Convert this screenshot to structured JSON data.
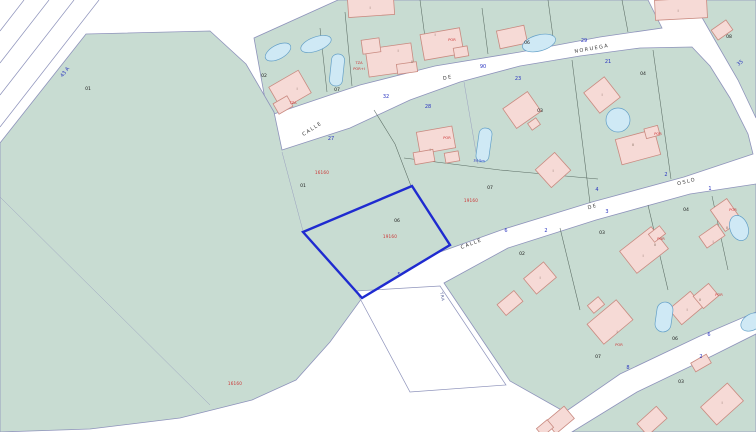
{
  "map": {
    "type": "cadastral-parcel-map",
    "colors": {
      "green": "#c8dcd2",
      "edge": "#8e93bb",
      "bld": "#f6dad6",
      "bldStroke": "#c98a80",
      "pool": "#cfe9f5",
      "poolStroke": "#64a0c8",
      "sel": "#1f2bd0",
      "blue": "#2a35c0",
      "red": "#cc3333",
      "ptext": "#222222",
      "bnd": "#5a6b63",
      "faint": "#9aa0bf"
    },
    "selected_parcel": {
      "id": "06",
      "code": "19160"
    },
    "street_names": [
      {
        "t": "CALLE",
        "x": 313,
        "y": 130,
        "r": -33
      },
      {
        "t": "DE",
        "x": 448,
        "y": 79,
        "r": -12
      },
      {
        "t": "NORUEGA",
        "x": 592,
        "y": 50,
        "r": -10
      },
      {
        "t": "CALLE",
        "x": 472,
        "y": 245,
        "r": -21
      },
      {
        "t": "DE",
        "x": 593,
        "y": 208,
        "r": -17
      },
      {
        "t": "OSLO",
        "x": 687,
        "y": 183,
        "r": -14
      },
      {
        "t": "TRA",
        "x": 441,
        "y": 297,
        "r": 78,
        "s": "tiny"
      }
    ],
    "portal_numbers": [
      {
        "t": "27",
        "x": 331,
        "y": 140
      },
      {
        "t": "32",
        "x": 386,
        "y": 98
      },
      {
        "t": "90",
        "x": 483,
        "y": 68
      },
      {
        "t": "28",
        "x": 428,
        "y": 108
      },
      {
        "t": "23",
        "x": 518,
        "y": 80
      },
      {
        "t": "29",
        "x": 584,
        "y": 42
      },
      {
        "t": "21",
        "x": 608,
        "y": 63
      },
      {
        "t": "43 A",
        "x": 66,
        "y": 73,
        "r": -52
      },
      {
        "t": "35",
        "x": 741,
        "y": 64,
        "r": -40
      },
      {
        "t": "5",
        "x": 399,
        "y": 276
      },
      {
        "t": "6",
        "x": 506,
        "y": 232
      },
      {
        "t": "2",
        "x": 546,
        "y": 232
      },
      {
        "t": "3",
        "x": 607,
        "y": 213
      },
      {
        "t": "4",
        "x": 597,
        "y": 191
      },
      {
        "t": "2",
        "x": 666,
        "y": 176
      },
      {
        "t": "1",
        "x": 710,
        "y": 190
      },
      {
        "t": "8",
        "x": 628,
        "y": 369
      },
      {
        "t": "2",
        "x": 701,
        "y": 358
      },
      {
        "t": "6",
        "x": 709,
        "y": 336
      },
      {
        "t": "34.5m",
        "x": 479,
        "y": 162,
        "r": 4,
        "s": "tiny"
      }
    ],
    "parcel_labels": [
      {
        "t": "01",
        "x": 88,
        "y": 90
      },
      {
        "t": "02",
        "x": 264,
        "y": 77
      },
      {
        "t": "07",
        "x": 337,
        "y": 91
      },
      {
        "t": "06",
        "x": 527,
        "y": 44
      },
      {
        "t": "08",
        "x": 729,
        "y": 38
      },
      {
        "t": "01",
        "x": 303,
        "y": 187
      },
      {
        "t": "06",
        "x": 397,
        "y": 222
      },
      {
        "t": "07",
        "x": 490,
        "y": 189
      },
      {
        "t": "04",
        "x": 643,
        "y": 75
      },
      {
        "t": "03",
        "x": 540,
        "y": 112
      },
      {
        "t": "02",
        "x": 522,
        "y": 255
      },
      {
        "t": "03",
        "x": 602,
        "y": 234
      },
      {
        "t": "04",
        "x": 686,
        "y": 211
      },
      {
        "t": "06",
        "x": 675,
        "y": 340
      },
      {
        "t": "07",
        "x": 598,
        "y": 358
      },
      {
        "t": "03",
        "x": 681,
        "y": 383
      }
    ],
    "red_codes": [
      {
        "t": "16160",
        "x": 322,
        "y": 174
      },
      {
        "t": "19160",
        "x": 390,
        "y": 238
      },
      {
        "t": "19160",
        "x": 471,
        "y": 202
      },
      {
        "t": "16160",
        "x": 235,
        "y": 385
      }
    ],
    "building_labels": [
      {
        "t": "TZA",
        "x": 293,
        "y": 104
      },
      {
        "t": "TZA",
        "x": 359,
        "y": 64
      },
      {
        "t": "POR+I",
        "x": 359,
        "y": 70
      },
      {
        "t": "POR",
        "x": 452,
        "y": 41
      },
      {
        "t": "POR",
        "x": 447,
        "y": 139
      },
      {
        "t": "POR",
        "x": 658,
        "y": 135
      },
      {
        "t": "POR",
        "x": 661,
        "y": 240
      },
      {
        "t": "POR",
        "x": 719,
        "y": 296
      },
      {
        "t": "POR",
        "x": 733,
        "y": 211
      },
      {
        "t": "POR",
        "x": 619,
        "y": 346
      }
    ],
    "roman_labels": [
      {
        "t": "I",
        "x": 297,
        "y": 90
      },
      {
        "t": "I",
        "x": 370,
        "y": 9
      },
      {
        "t": "I",
        "x": 398,
        "y": 52
      },
      {
        "t": "II",
        "x": 412,
        "y": 63
      },
      {
        "t": "I",
        "x": 435,
        "y": 36
      },
      {
        "t": "I",
        "x": 678,
        "y": 12
      },
      {
        "t": "I",
        "x": 430,
        "y": 151
      },
      {
        "t": "I",
        "x": 553,
        "y": 172
      },
      {
        "t": "I",
        "x": 602,
        "y": 96
      },
      {
        "t": "II",
        "x": 633,
        "y": 146
      },
      {
        "t": "I",
        "x": 643,
        "y": 257
      },
      {
        "t": "II",
        "x": 655,
        "y": 246
      },
      {
        "t": "I",
        "x": 687,
        "y": 311
      },
      {
        "t": "II",
        "x": 700,
        "y": 301
      },
      {
        "t": "I",
        "x": 713,
        "y": 243
      },
      {
        "t": "II",
        "x": 727,
        "y": 229
      },
      {
        "t": "I",
        "x": 617,
        "y": 333
      },
      {
        "t": "I",
        "x": 540,
        "y": 279
      },
      {
        "t": "I",
        "x": 722,
        "y": 404
      }
    ]
  }
}
